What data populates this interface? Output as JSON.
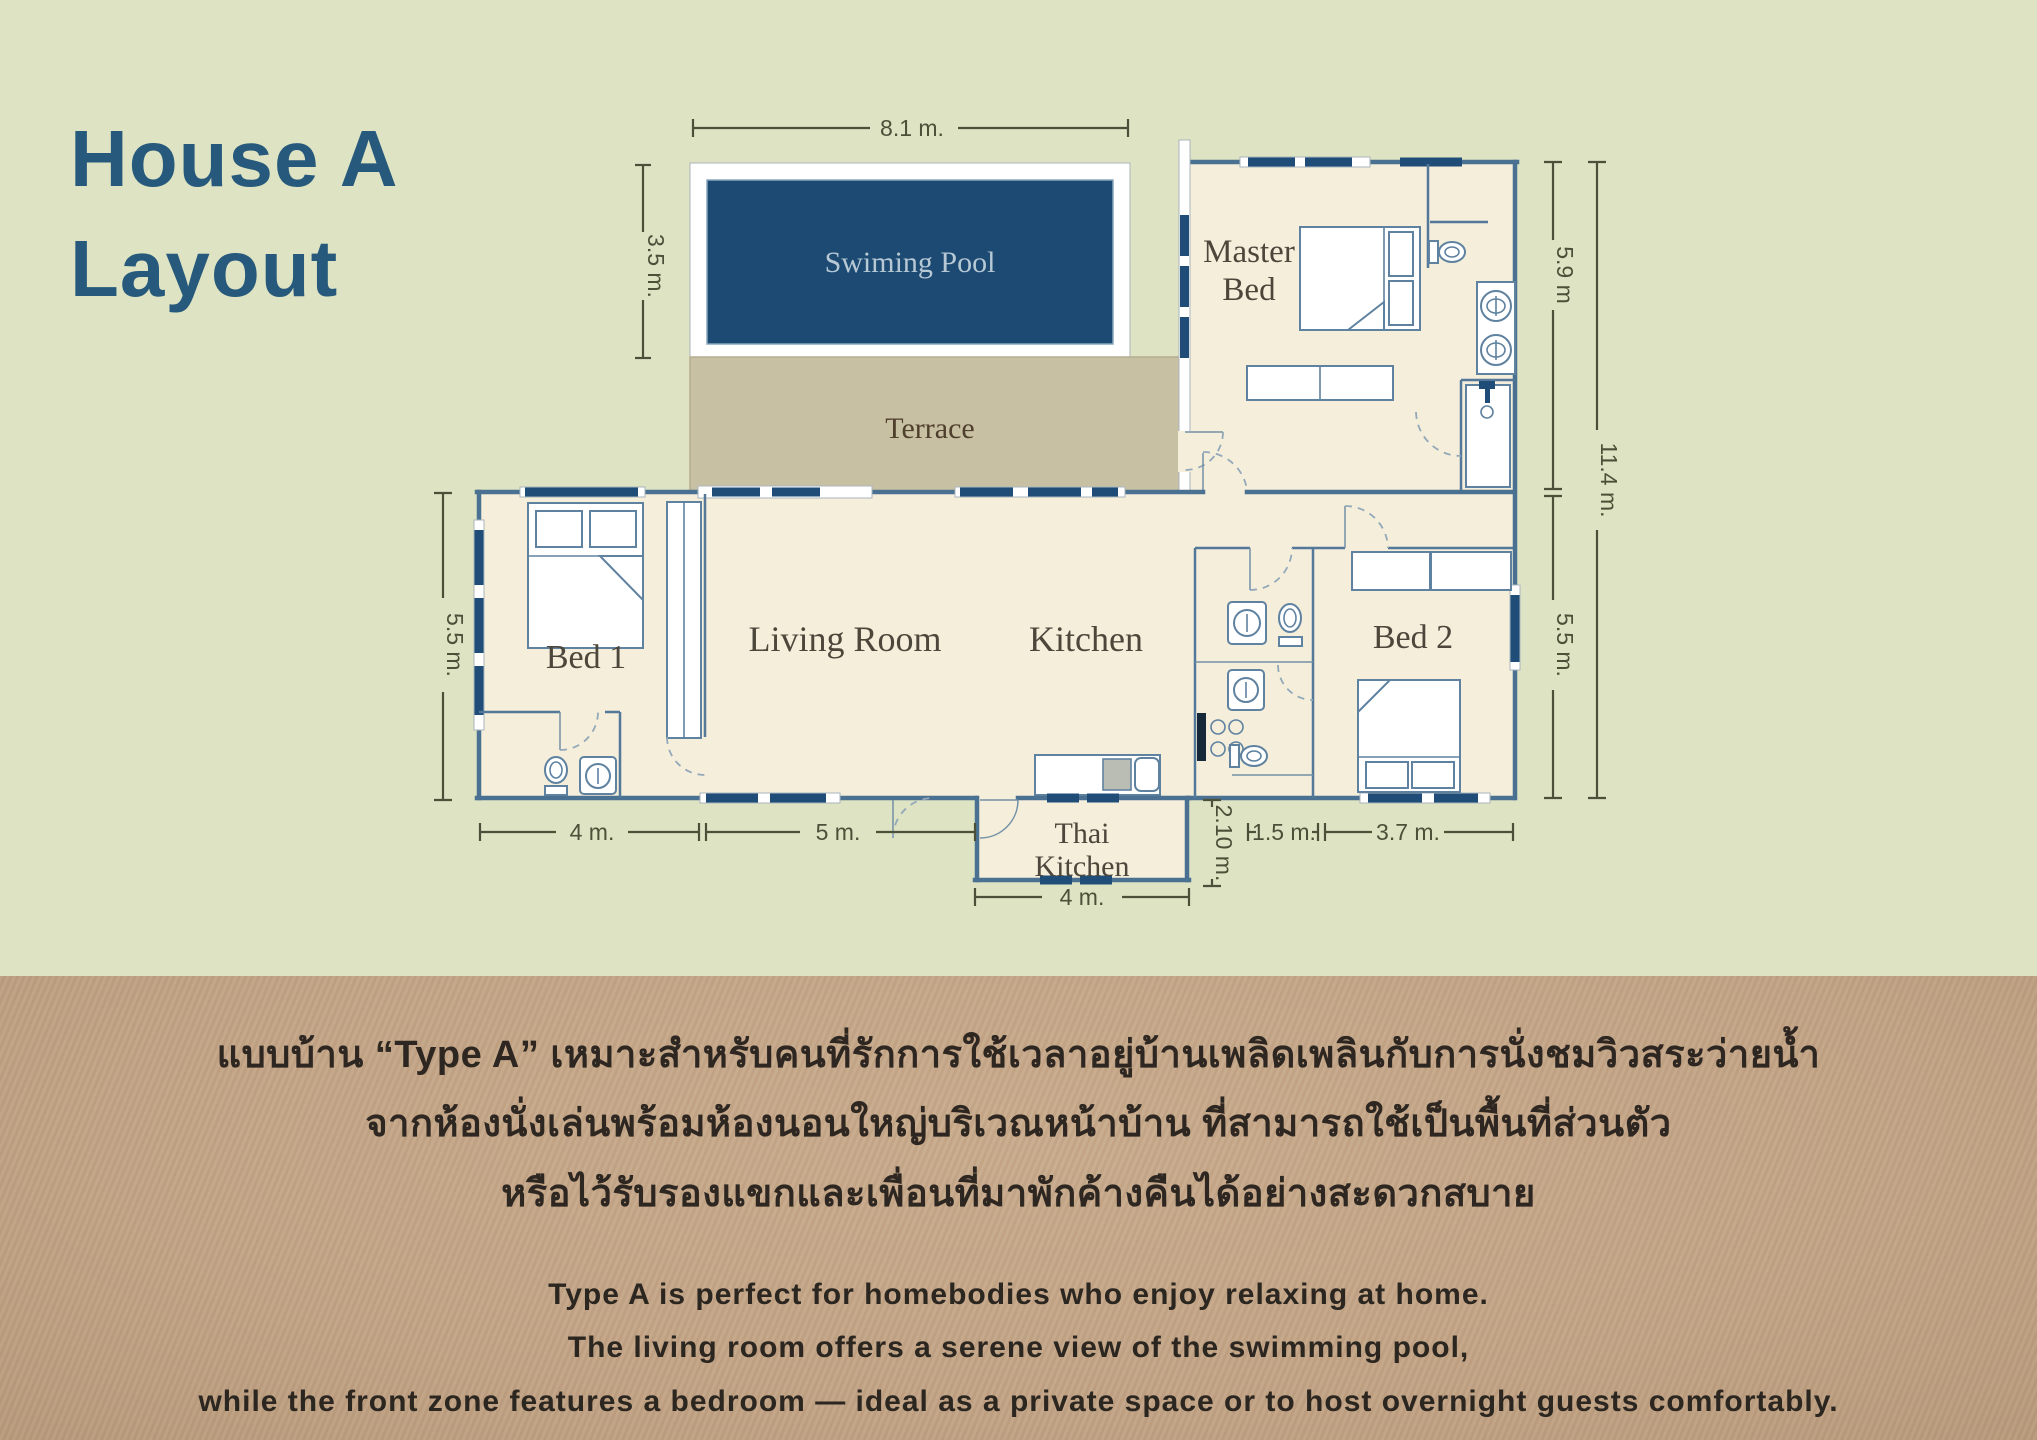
{
  "title": {
    "line1": "House A",
    "line2": "Layout"
  },
  "plan": {
    "rooms": {
      "pool": "Swiming Pool",
      "terrace": "Terrace",
      "master_line1": "Master",
      "master_line2": "Bed",
      "bed1": "Bed 1",
      "living": "Living Room",
      "kitchen": "Kitchen",
      "bed2": "Bed 2",
      "thai_line1": "Thai",
      "thai_line2": "Kitchen"
    },
    "dims": {
      "pool_width": "8.1 m.",
      "pool_height": "3.5 m.",
      "left_height": "5.5 m.",
      "right_top": "5.9 m",
      "right_total": "11.4 m.",
      "right_bottom": "5.5 m.",
      "bottom_bed1": "4 m.",
      "bottom_living": "5 m.",
      "thai_kitchen_height": "2.10 m.",
      "bottom_bath": "1.5 m.",
      "bottom_bed2": "3.7 m.",
      "thai_kitchen_width": "4 m."
    }
  },
  "description": {
    "thai_lines": [
      "แบบบ้าน “Type A” เหมาะสำหรับคนที่รักการใช้เวลาอยู่บ้านเพลิดเพลินกับการนั่งชมวิวสระว่ายน้ำ",
      "จากห้องนั่งเล่นพร้อมห้องนอนใหญ่บริเวณหน้าบ้าน ที่สามารถใช้เป็นพื้นที่ส่วนตัว",
      "หรือไว้รับรองแขกและเพื่อนที่มาพักค้างคืนได้อย่างสะดวกสบาย"
    ],
    "english_lines": [
      "Type A is perfect for homebodies who enjoy relaxing at home.",
      "The living room offers a serene view of the swimming pool,",
      "while the front zone features a  bedroom — ideal as a private space or to host overnight guests comfortably."
    ]
  },
  "colors": {
    "background": "#dde3c3",
    "accent_blue": "#26597b",
    "pool": "#1d4a72",
    "terrace": "#c8c0a3",
    "room_fill": "#f4eedb",
    "wall": "#4a7191",
    "band": "#c2a385"
  }
}
